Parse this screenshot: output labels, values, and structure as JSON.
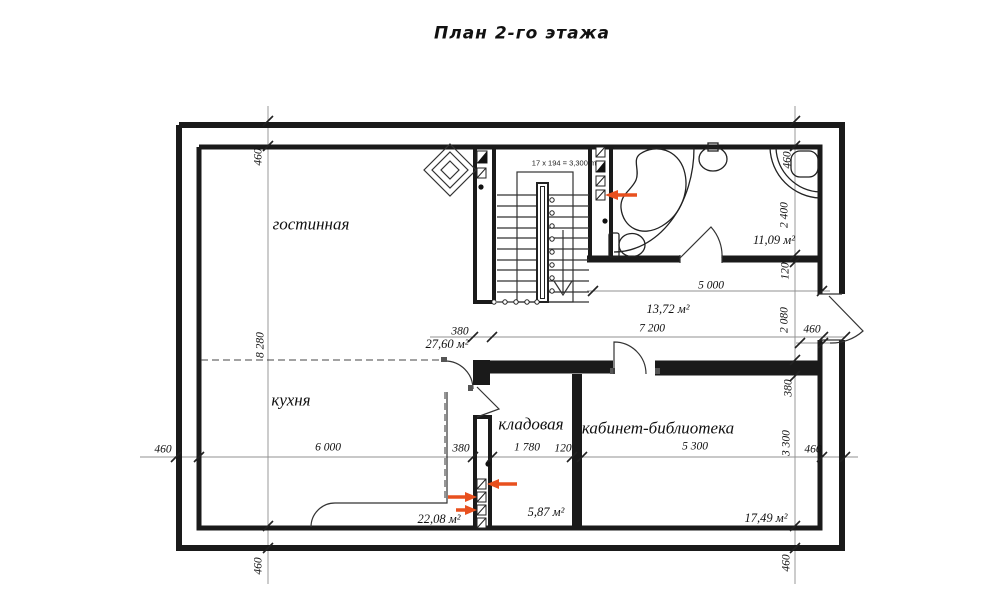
{
  "title": "План 2-го этажа",
  "colors": {
    "ink": "#1a1a1a",
    "dim_line": "#909090",
    "marker": "#e8501e"
  },
  "stairs": {
    "formula": "17 x 194 = 3,300 m"
  },
  "rooms": {
    "living": {
      "name": "гостинная",
      "area": "27,60 м²"
    },
    "kitchen": {
      "name": "кухня",
      "area": "22,08 м²"
    },
    "storage": {
      "name": "кладовая",
      "area": "5,87 м²"
    },
    "office": {
      "name": "кабинет-библиотека",
      "area": "17,49 м²"
    },
    "hall": {
      "area": "13,72 м²"
    },
    "bathroom": {
      "area": "11,09 м²"
    }
  },
  "dimensions": {
    "left": {
      "wall_top": "460",
      "interior_height": "8 280",
      "wall_bottom": "460"
    },
    "right": {
      "wall_top": "460",
      "bathroom_depth": "2 400",
      "bathroom_wall": "120",
      "hall_depth": "2 080",
      "office_wall": "380",
      "office_depth": "3 300",
      "wall_bottom": "460",
      "balcony_door": "460"
    },
    "bottom": {
      "wall_left": "460",
      "kitchen_width": "6 000",
      "stair_wall": "380",
      "storage_width": "1 780",
      "divider_wall": "120",
      "office_width": "5 300",
      "wall_right": "460"
    },
    "inner": {
      "bathroom_width": "5 000",
      "hall_width": "7 200",
      "stair_wall": "380"
    }
  }
}
